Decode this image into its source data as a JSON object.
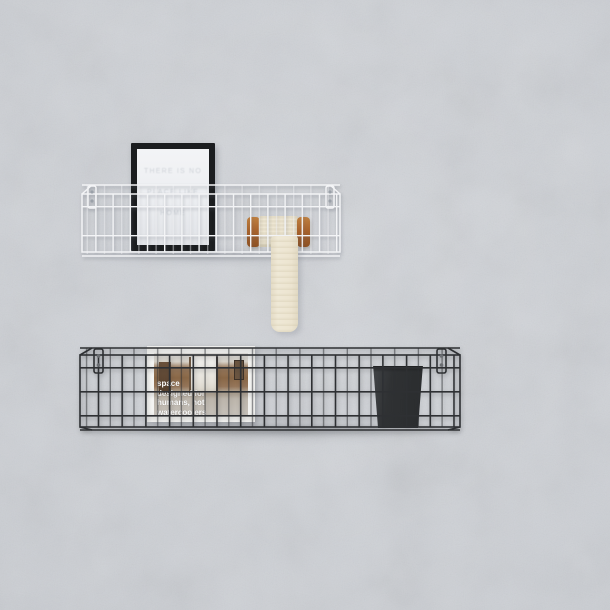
{
  "scene": {
    "description": "Two wall-mounted wire grid basket shelves on a light grey concrete wall; the upper white basket holds a black picture frame and a wooden spool with cream lace ribbon hanging down; the lower black basket holds a white framed interior photo card and a dark cup",
    "wall_color": "#ced1d6"
  },
  "white_shelf": {
    "label": "white wire basket shelf",
    "wire_color": "#f3f4f6",
    "screw_color": "#9aa0a8",
    "picture_frame": {
      "frame_color": "#1b1d1f",
      "paper_color": "#f3f4f6",
      "faint_text_lines": [
        "THERE IS NO",
        "PLACE LIKE",
        "HOME"
      ]
    },
    "spool": {
      "wood_color": "#a9632c",
      "lace_color": "#ece4d0"
    }
  },
  "black_shelf": {
    "label": "black wire basket shelf",
    "wire_color": "#2e3033",
    "screw_color": "#6a6d71",
    "photo_card": {
      "matte_color": "#f4f4f2",
      "caption_color": "#ffffff",
      "caption_lines": [
        "space",
        "designed for",
        "humans, not",
        "watercoolers"
      ]
    },
    "cup": {
      "color": "#303234"
    }
  }
}
